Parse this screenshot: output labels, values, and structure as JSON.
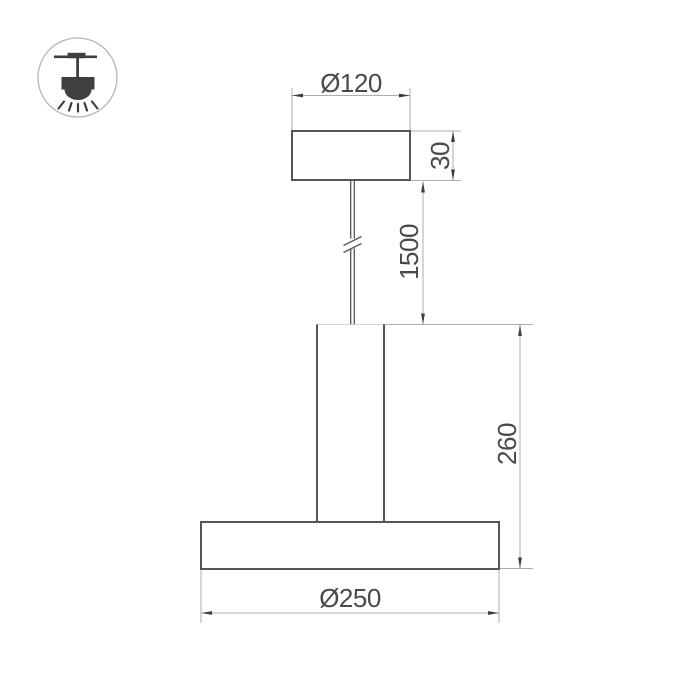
{
  "window": {
    "background_color": "#ffffff"
  },
  "icon_badge": {
    "name": "pendant-lamp-icon"
  },
  "drawing": {
    "dimensions": {
      "canopy_diameter": "Ø120",
      "canopy_height": "30",
      "suspension_length": "1500",
      "body_height": "260",
      "shade_diameter": "Ø250"
    },
    "colors": {
      "object_line": "#555555",
      "dimension_line": "#adadad",
      "arrow": "#3c3c3c",
      "text": "#4a4a4a",
      "icon_glyph": "#3f3f3f",
      "icon_ring": "#b5b5b5"
    }
  }
}
